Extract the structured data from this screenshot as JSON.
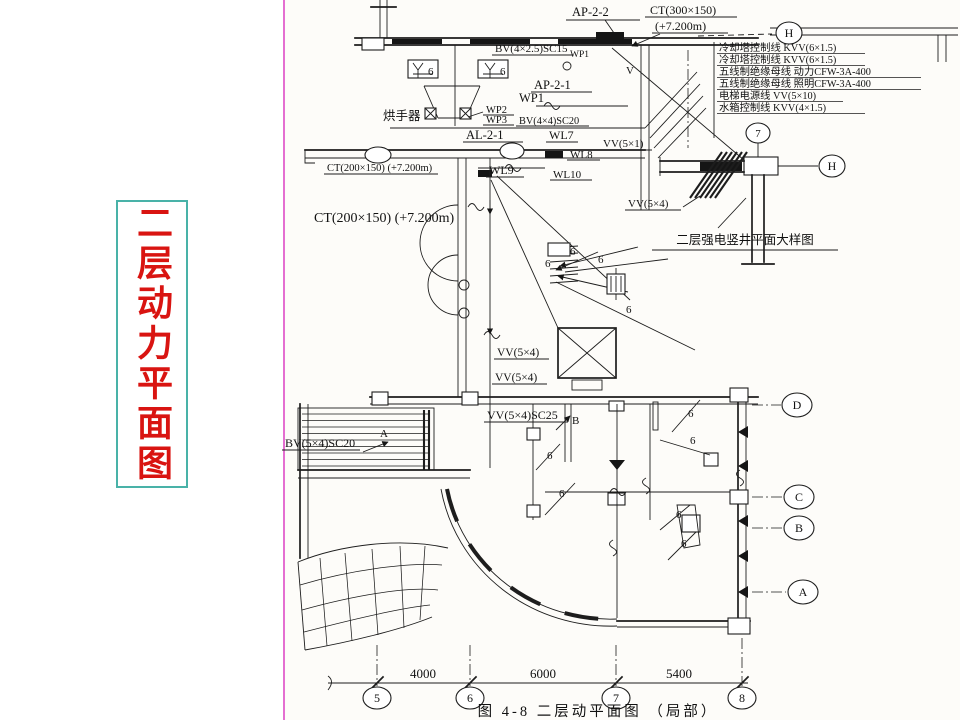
{
  "slide": {
    "vertical_title": "二层动力平面图",
    "colors": {
      "title_red": "#d91411",
      "title_box_border_teal": "#49b2a8",
      "divider_pink": "#e46fd1",
      "drawing_ink": "#1d1d1d"
    }
  },
  "plan": {
    "caption": "图 4-8  二层动平面图 （局部）",
    "panels": {
      "ap22": "AP-2-2",
      "ap21": "AP-2-1",
      "al21": "AL-2-1"
    },
    "trays": {
      "ct300": "CT(300×150)",
      "ct300_elev": "(+7.200m)",
      "ct200": "CT(200×150) (+7.200m)"
    },
    "wires": {
      "bv4_25_sc15": "BV(4×2.5)SC15",
      "bv4_4_sc20": "BV(4×4)SC20",
      "bv5_4_sc20": "BV(5×4)SC20",
      "vv5_1": "VV(5×1)",
      "vv5_4": "VV(5×4)",
      "vv5_4_sc25": "VV(5×4)SC25",
      "wp1": "WP1",
      "wp2": "WP2",
      "wp3": "WP3",
      "wl7": "WL7",
      "wl8": "WL8",
      "wl9": "WL9",
      "wl10": "WL10",
      "v": "V"
    },
    "equipment": {
      "hand_dryer": "烘手器"
    },
    "markers": {
      "point_a": "A",
      "point_b": "B",
      "circuit": "6"
    },
    "grid": {
      "bottom": [
        "5",
        "6",
        "7",
        "8"
      ],
      "right": [
        "D",
        "C",
        "B",
        "A"
      ],
      "h": "H",
      "seven": "7"
    },
    "dimensions": [
      "4000",
      "6000",
      "5400"
    ]
  },
  "riser_detail": {
    "caption": "二层强电竖井平面大样图",
    "vv5_4": "VV(5×4)",
    "cable_list": [
      "冷却塔控制线 KVV(6×1.5)",
      "冷却塔控制线 KVV(6×1.5)",
      "五线制绝缘母线 动力CFW-3A-400",
      "五线制绝缘母线 照明CFW-3A-400",
      "电梯电源线 VV(5×10)",
      "水箱控制线 KVV(4×1.5)"
    ]
  }
}
